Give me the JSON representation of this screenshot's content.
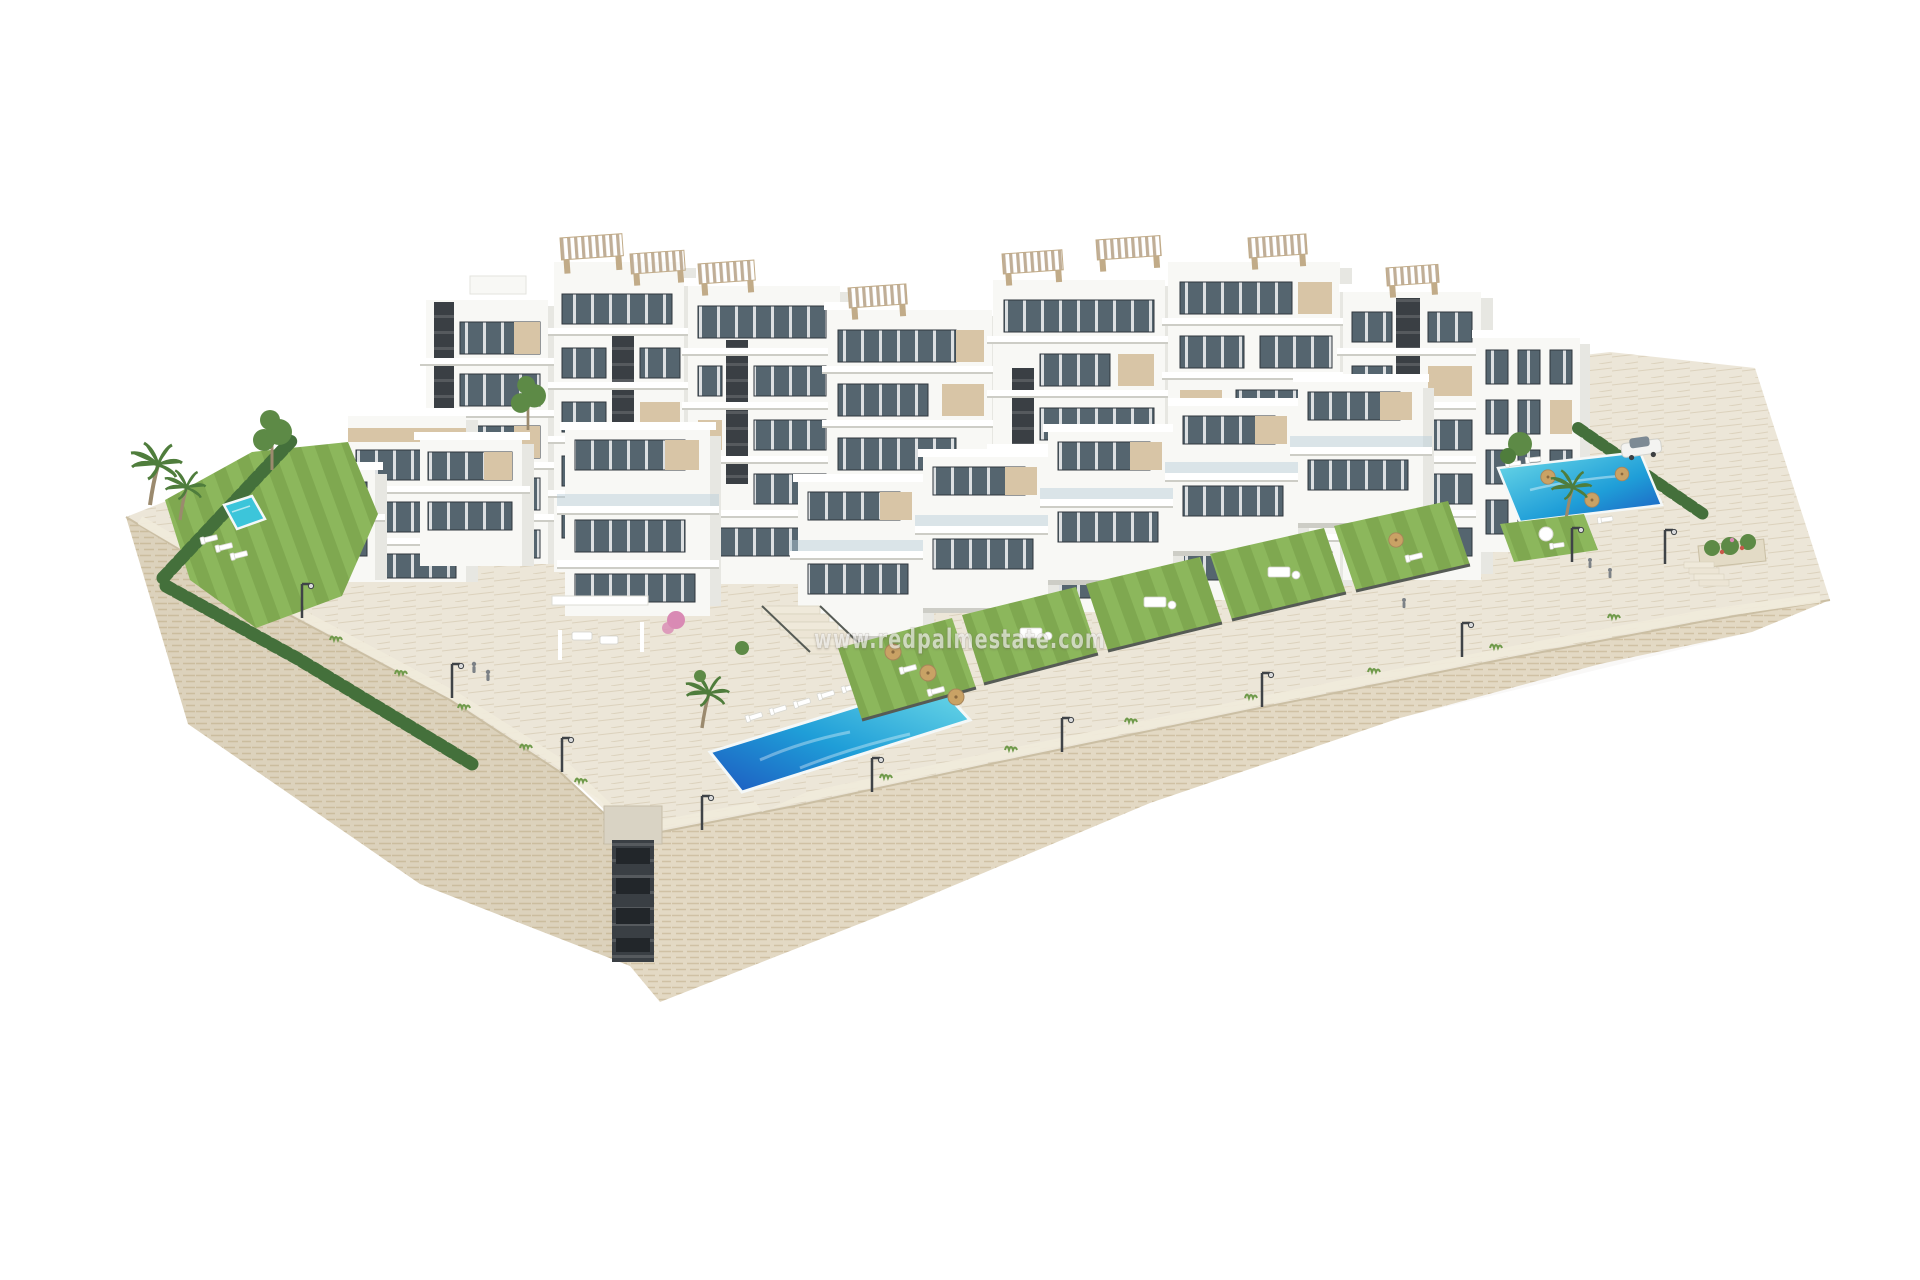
{
  "image": {
    "kind": "architectural-3d-render",
    "subject": "aerial view of a modern white residential complex with stepped apartment blocks, rooftop pergolas, private lawns, three swimming pools, palm trees and a stone retaining wall on a white background"
  },
  "watermark": {
    "text": "www.redpalmestate.com",
    "color": "#ffffff",
    "opacity": 0.62
  },
  "palette": {
    "stone": "#e8dfca",
    "stone-line": "#d4c6a8",
    "pave": "#ece6d8",
    "pave-line": "#dcd2bd",
    "lawn": "#7fa850",
    "lawn-light": "#8cb75c",
    "hedge": "#44703b",
    "bush": "#5d8a46",
    "palm": "#4f7d3c",
    "trunk": "#9b8a6e",
    "building-front": "#f8f8f5",
    "building-side": "#e7e7e2",
    "building-parapet": "#ffffff",
    "slab-shadow": "#cdcdc6",
    "beige": "#d8c5a6",
    "beige-dark": "#c1ab88",
    "core-dark": "#3a3f44",
    "window-frame": "#2f363d",
    "glass": "#55656f",
    "railing-glass": "#b6cdd9",
    "pergola": "#c0ae97",
    "pool-deep": "#1d59c0",
    "pool-mid": "#1f9ed8",
    "pool-light": "#70dce8",
    "pool-small": "#3cc5da",
    "pool-edge": "#f4f8f8",
    "umbrella": "#c9a265",
    "car-body": "#f3f3f1",
    "car-glass": "#7d8a94",
    "flower-pink": "#d98ab4",
    "flower-red": "#c8584a",
    "lamp": "#3f4347",
    "fence": "#565b55",
    "tuft": "#6f9a4a",
    "figure": "#7c8186"
  }
}
